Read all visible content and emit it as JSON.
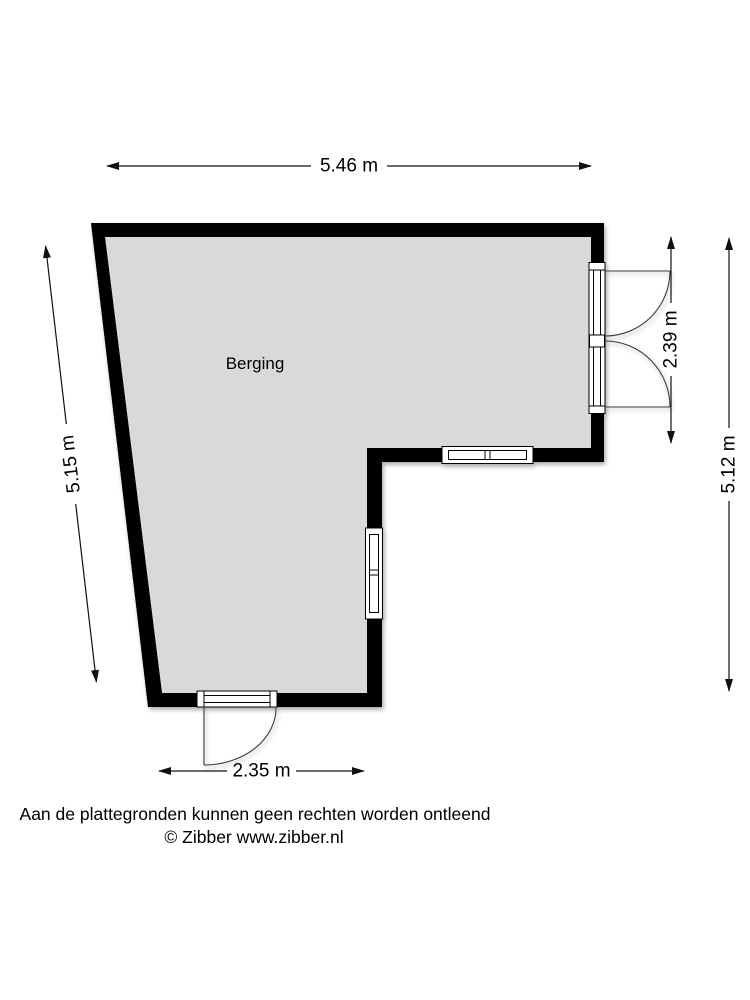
{
  "plan": {
    "room": {
      "label": "Berging"
    },
    "dimensions": {
      "top_width": "5.46 m",
      "left_height": "5.15 m",
      "right_door_height": "2.39 m",
      "right_total_height": "5.12 m",
      "bottom_door_width": "2.35 m"
    },
    "footer": {
      "disclaimer": "Aan de plattegronden kunnen geen rechten worden ontleend",
      "credit": "© Zibber www.zibber.nl"
    },
    "colors": {
      "wall": "#000000",
      "floor": "#d9d9d9",
      "background": "#ffffff",
      "line": "#111111"
    },
    "icons": {
      "dimension_arrow": "double-headed-arrow",
      "door_swing": "quarter-arc"
    }
  }
}
